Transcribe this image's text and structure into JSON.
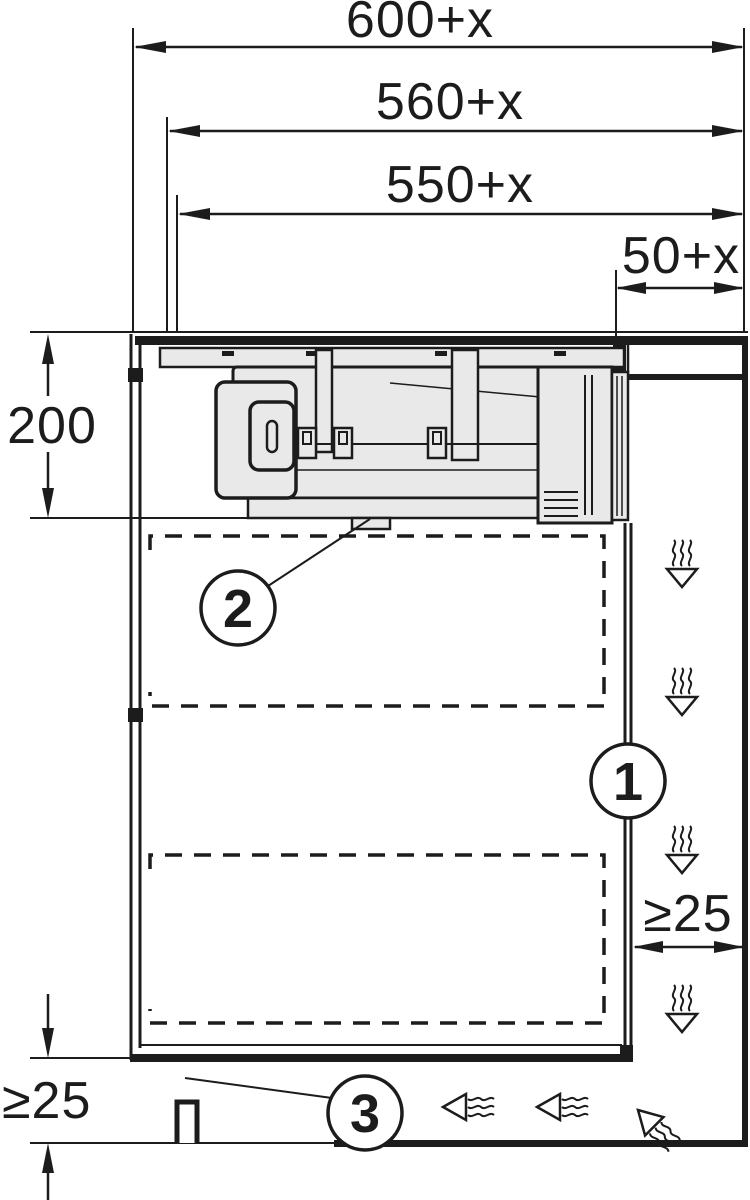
{
  "diagram_type": "appliance-installation-cross-section",
  "dimensions": {
    "width_total": {
      "label": "600+x"
    },
    "width_cutout": {
      "label": "560+x"
    },
    "width_appliance": {
      "label": "550+x"
    },
    "offset_rear": {
      "label": "50+x"
    },
    "depth_below_worktop": {
      "label": "200"
    },
    "rear_gap_min": {
      "label": "≥25"
    },
    "plinth_gap_min": {
      "label": "≥25"
    }
  },
  "callouts": [
    {
      "number": "1"
    },
    {
      "number": "2"
    },
    {
      "number": "3"
    }
  ],
  "colors": {
    "line": "#1c1c1c",
    "appliance_fill": "#e9e9e9",
    "background": "#ffffff"
  }
}
